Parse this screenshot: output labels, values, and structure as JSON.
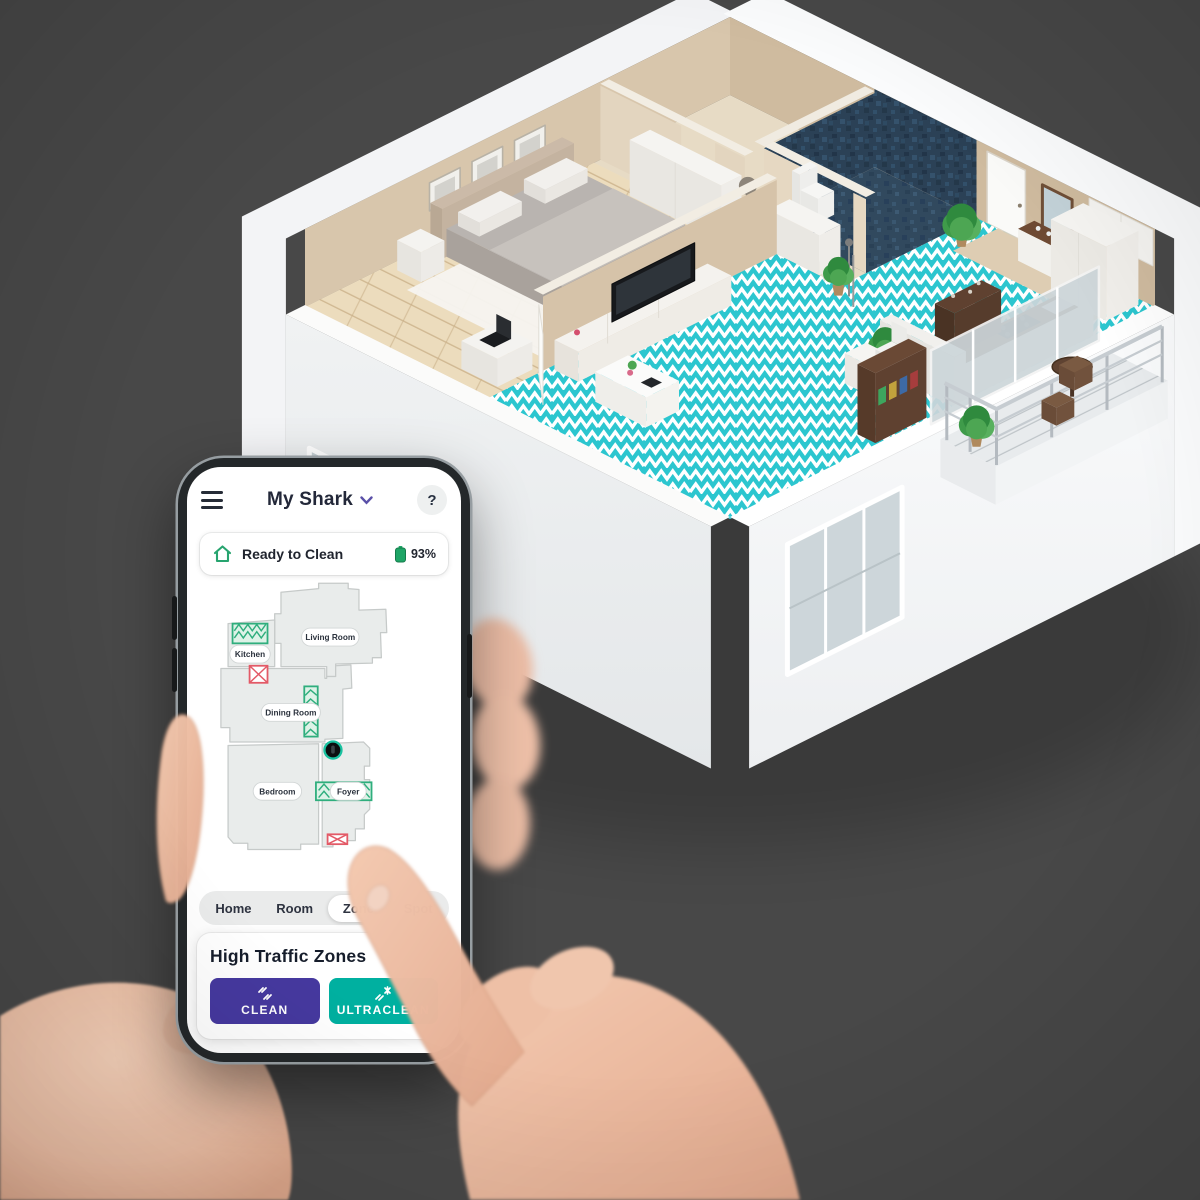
{
  "scene": {
    "background_color": "#474747",
    "floorplan_floor_accent": "#2cc6cf",
    "description_labels": {
      "apartment": "3d-apartment-floorplan",
      "hands": "hands-holding-phone"
    }
  },
  "phone": {
    "header": {
      "title": "My Shark",
      "help_label": "?"
    },
    "status": {
      "label": "Ready to Clean",
      "battery_level": "93%"
    },
    "map": {
      "rooms": [
        {
          "label": "Kitchen"
        },
        {
          "label": "Living Room"
        },
        {
          "label": "Dining Room"
        },
        {
          "label": "Bedroom"
        },
        {
          "label": "Foyer"
        }
      ],
      "zone_color": "#2fae7d",
      "nogo_color": "#e35a67",
      "robot_ring_color": "#19c2a0"
    },
    "tabs": [
      {
        "label": "Home"
      },
      {
        "label": "Room"
      },
      {
        "label": "Zone"
      },
      {
        "label": "Spot"
      }
    ],
    "selected_tab": "Zone",
    "card": {
      "title": "High Traffic Zones",
      "buttons": [
        {
          "label": "CLEAN",
          "color": "#46399f"
        },
        {
          "label": "ULTRACLEAN",
          "color": "#00b0a0"
        }
      ]
    }
  }
}
